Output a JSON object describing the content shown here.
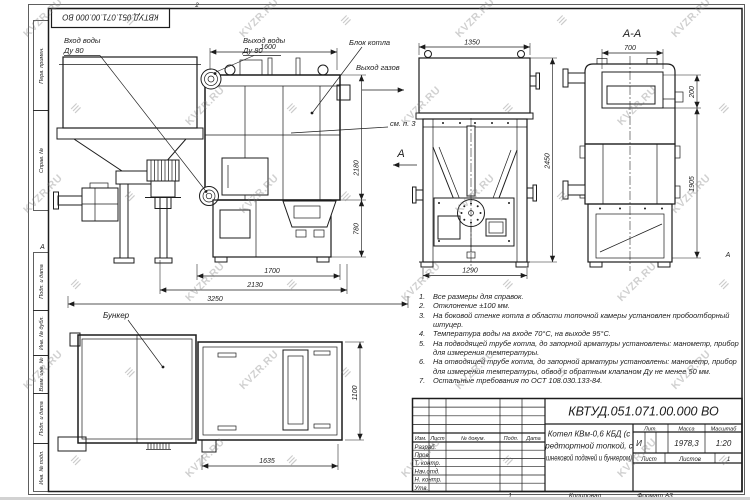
{
  "stamp": {
    "doc_number_top": "КВТУД.051.071.00.000 ВО"
  },
  "frame": {
    "left_labels": [
      "Перв. примен.",
      "Справ. №",
      "Подп. и дата",
      "Инв. № дубл.",
      "Взам. инв. №",
      "Подп. и дата",
      "Инв. № подл."
    ],
    "zone_left": "А",
    "zone_right": "А",
    "top_mark": "2"
  },
  "callouts": {
    "water_in_line1": "Вход воды",
    "water_in_line2": "Ду 80",
    "water_out_line1": "Выход воды",
    "water_out_line2": "Ду 80",
    "boiler_block": "Блок котла",
    "gas_out": "Выход газов",
    "see_note": "см. п. 3",
    "cut_arrow_label": "А",
    "section_title": "А-А",
    "bunker": "Бункер"
  },
  "dims": {
    "side_width_top": "1600",
    "side_height": "2180",
    "side_ash_height": "780",
    "side_bottom_1": "1700",
    "side_bottom_2": "2130",
    "side_bottom_3": "3250",
    "front_width_top": "1350",
    "front_height": "2450",
    "front_bottom": "1290",
    "section_width_top": "700",
    "section_top_offset": "200",
    "section_height": "1905",
    "plan_bottom": "1635",
    "plan_height": "1100"
  },
  "notes": {
    "items": [
      {
        "num": "1.",
        "text": "Все размеры для справок."
      },
      {
        "num": "2.",
        "text": "Отклонение ±100 мм."
      },
      {
        "num": "3.",
        "text": "На боковой стенке котла в области топочной камеры установлен пробоотборный штуцер."
      },
      {
        "num": "4.",
        "text": "Температура воды на входе 70°С, на выходе 95°С."
      },
      {
        "num": "5.",
        "text": "На подводящей трубе котла, до запорной арматуры установлены: манометр, прибор для измерения температуры."
      },
      {
        "num": "6.",
        "text": "На отводящей трубе котла, до запорной арматуры установлены: манометр, прибор для измерения температуры, обвод с обратным клапаном Ду не менее 50 мм."
      },
      {
        "num": "7.",
        "text": "Остальные требования по ОСТ 108.030.133-84."
      }
    ]
  },
  "title_block": {
    "doc_number": "КВТУД.051.071.00.000 ВО",
    "product_name_lines": [
      "Котел КВм-0,6 КБД (с",
      "редтортной топкой, с",
      "шнековой подачей и бункером)"
    ],
    "rev_header": [
      "Изм.",
      "Лист",
      "№ докум.",
      "Подп.",
      "Дата"
    ],
    "sig_labels": [
      "Разраб.",
      "Пров.",
      "Т. контр.",
      "Нач.отд.",
      "Н. контр.",
      "Утв."
    ],
    "lit_label": "Лит.",
    "mass_label": "Масса",
    "scale_label": "Масштаб",
    "lit_value": "И",
    "mass_value": "1978,3",
    "scale_value": "1:20",
    "sheet_label": "Лист",
    "sheets_label": "Листов",
    "sheets_value": "1",
    "footer_num": "1",
    "copied": "Копировал",
    "format": "Формат А3"
  },
  "watermark": {
    "text": "KVZR.RU",
    "logo_glyph": "≡"
  }
}
